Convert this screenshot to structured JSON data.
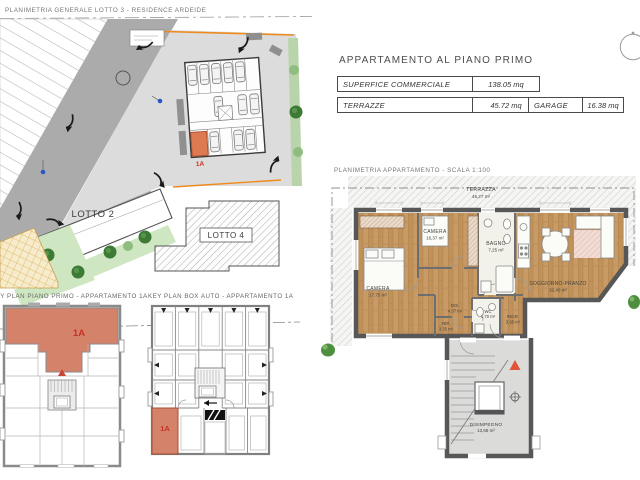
{
  "header": {
    "title": "APPARTAMENTO AL PIANO PRIMO",
    "table": {
      "rows": [
        {
          "label": "SUPERFICE COMMERCIALE",
          "value": "138.05 mq"
        },
        {
          "label": "TERRAZZE",
          "value": "45.72 mq"
        }
      ]
    },
    "garage_table": {
      "label": "GARAGE",
      "value": "16.38 mq"
    }
  },
  "site_plan": {
    "title": "PLANIMETRIA GENERALE LOTTO 3 - RESIDENCE ARDEIDE",
    "lotto2_label": "LOTTO 2",
    "lotto4_label": "LOTTO 4",
    "parking_stall_label": "1A"
  },
  "keyplan_floor": {
    "title": "KEY PLAN PIANO PRIMO - APPARTAMENTO 1A",
    "unit_label": "1A"
  },
  "keyplan_garage": {
    "title": "KEY PLAN BOX AUTO - APPARTAMENTO 1A",
    "unit_label": "1A"
  },
  "apartment_plan": {
    "title": "PLANIMETRIA APPARTAMENTO - SCALA 1:100",
    "rooms": {
      "terrazza": {
        "name": "TERRAZZA",
        "area": "46,27 m²"
      },
      "camera_small": {
        "name": "CAMERA",
        "area": "16,37 m²"
      },
      "camera_large": {
        "name": "CAMERA",
        "area": "17,75 m²"
      },
      "bagno": {
        "name": "BAGNO",
        "area": "7,25 m²"
      },
      "dis": {
        "name": "DIS.",
        "area": "4,37 m²"
      },
      "rip": {
        "name": "RIP.",
        "area": "3,35 m²"
      },
      "wc": {
        "name": "WC",
        "area": "1,70 m²"
      },
      "ingr": {
        "name": "INGR.",
        "area": "3,95 m²"
      },
      "soggiorno": {
        "name": "SOGGIORNO-PRANZO",
        "area": "32,40 m²"
      },
      "disimpegno": {
        "name": "DISIMPEGNO",
        "area": "13,68 m²"
      }
    }
  },
  "colors": {
    "highlight_unit": "#d5826a",
    "unit_text_red": "#c63b2a",
    "wood_floor": "#c89a66",
    "wall_dark": "#575757",
    "boundary_orange": "#ef8a1c",
    "green_dark": "#3d7a35",
    "green_light": "#cfe6c2",
    "road_gray": "#ababab"
  }
}
